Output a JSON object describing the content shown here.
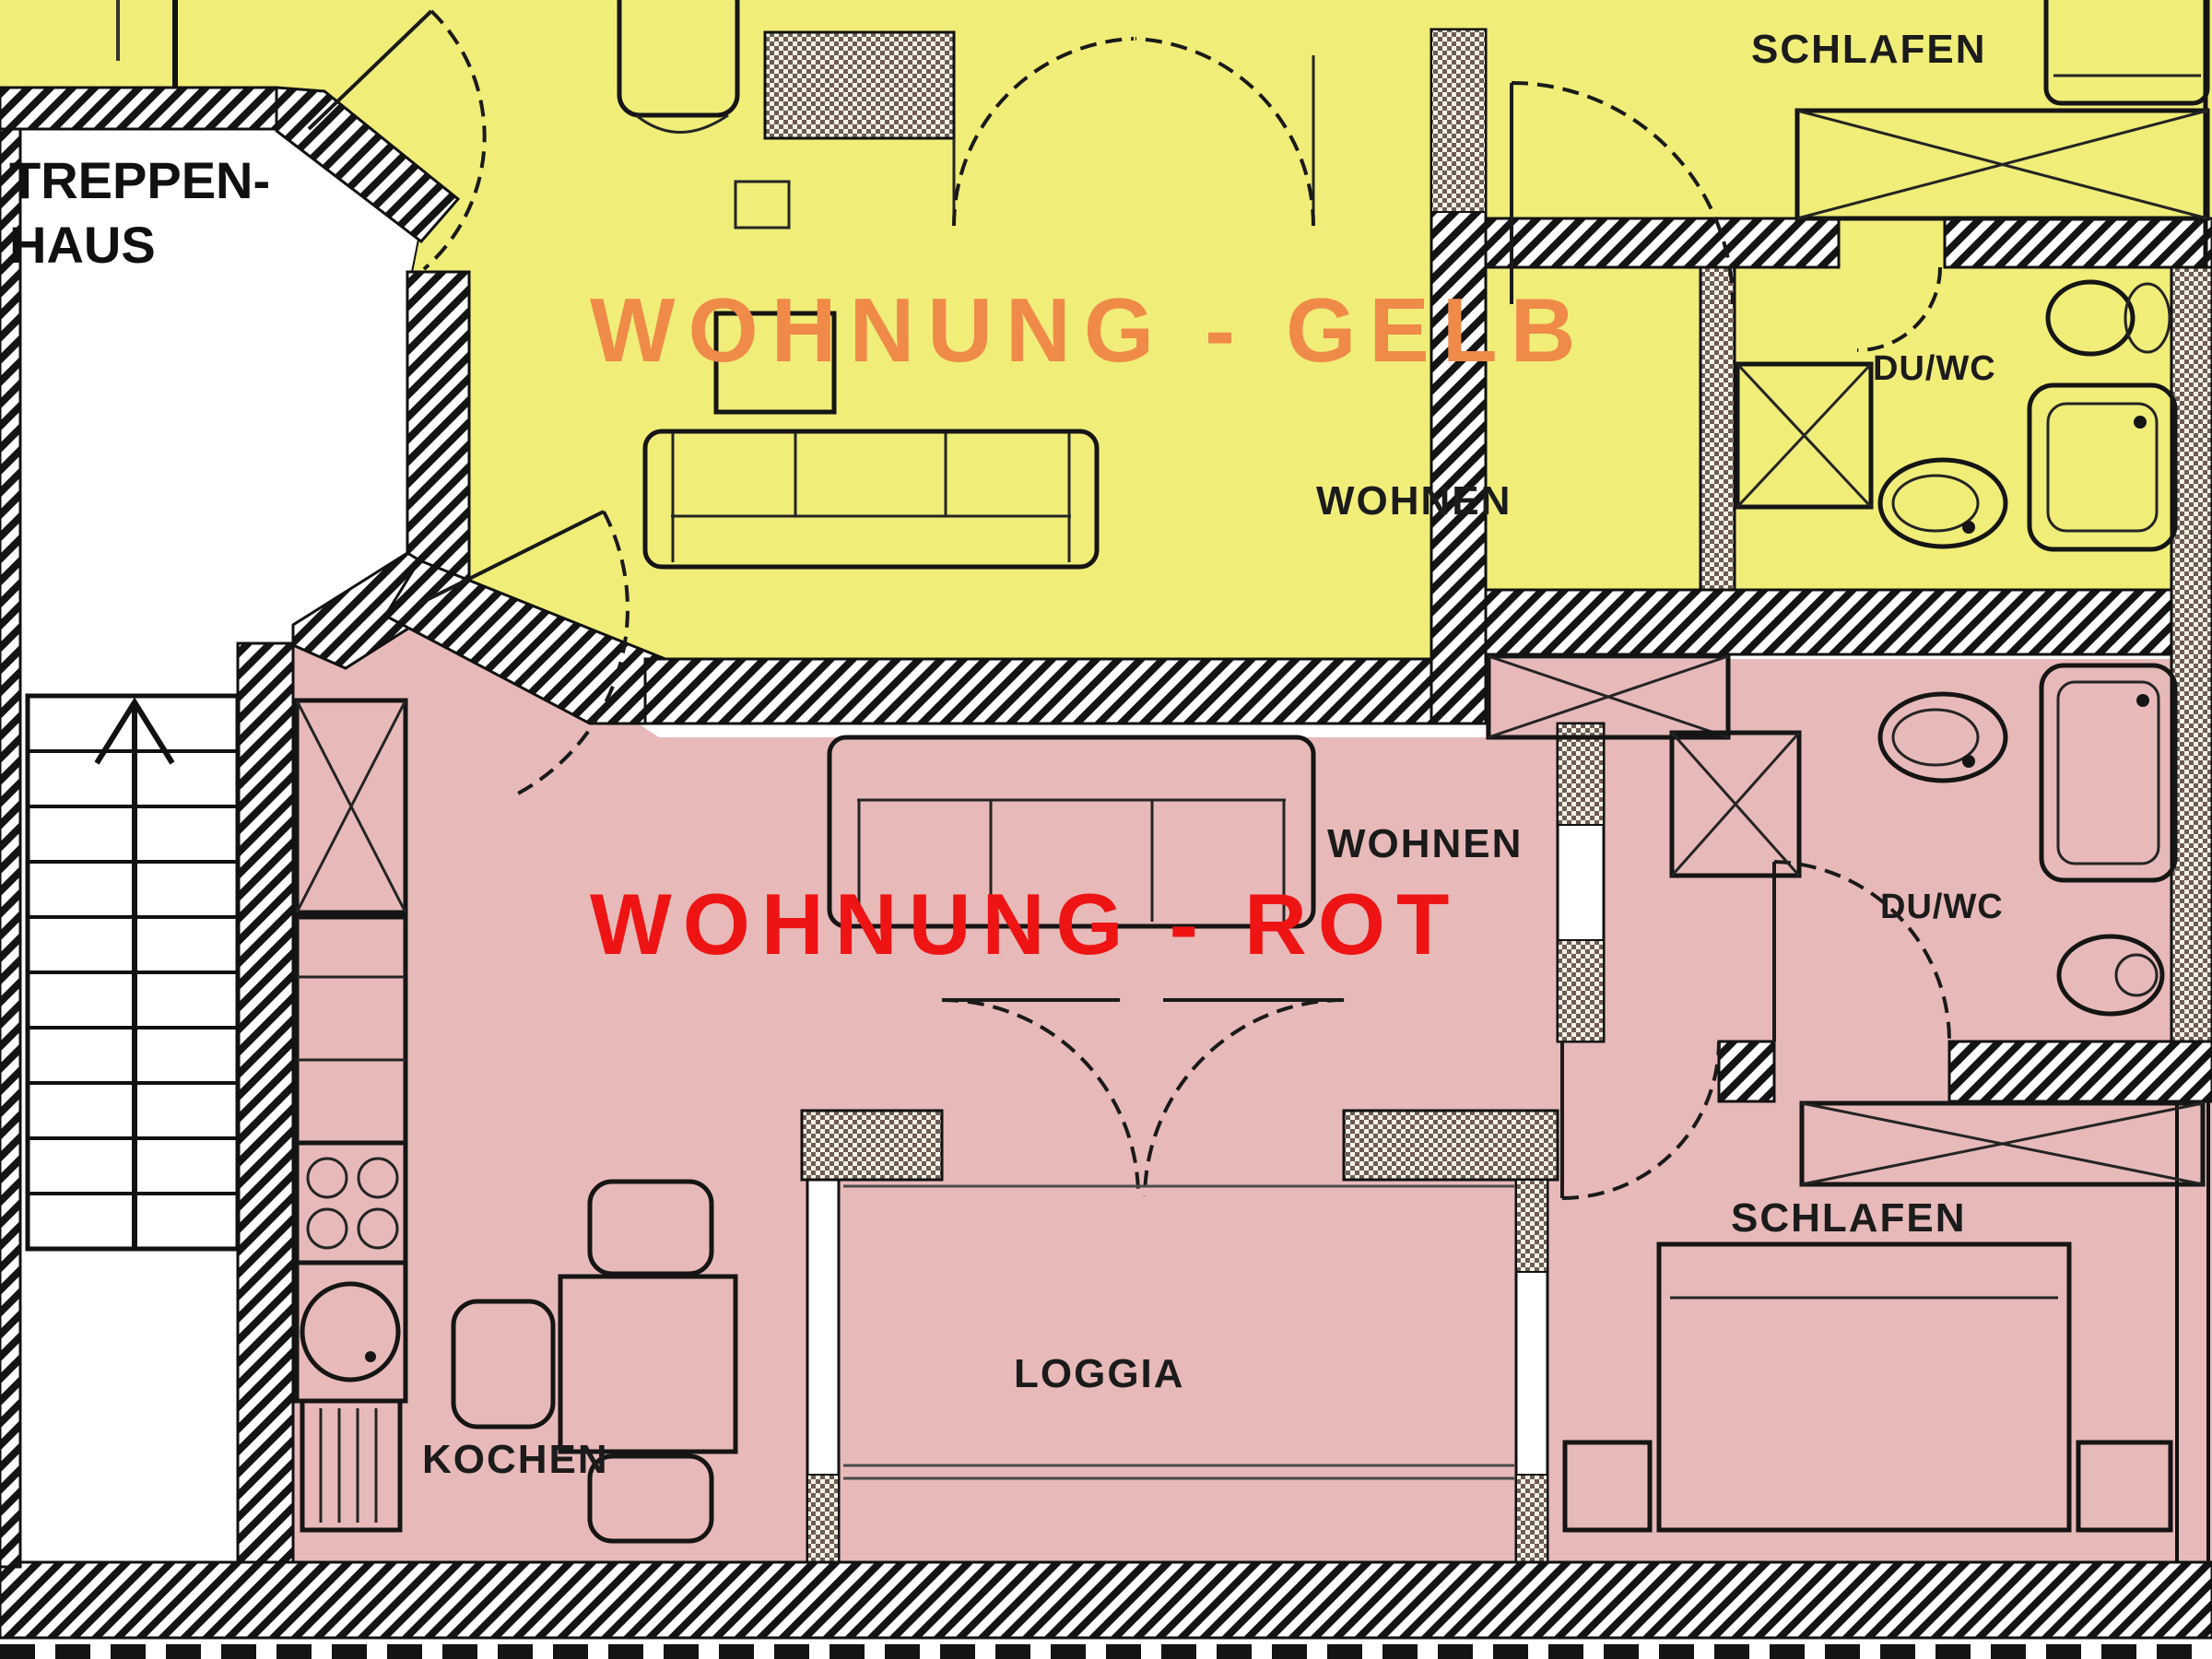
{
  "title": "Grundriss – Wohnung Gelb / Wohnung Rot",
  "colors": {
    "gelb_floor": "#f0ed79",
    "rot_floor": "#e8b9b9",
    "gelb_title": "#ef8a49",
    "rot_title": "#ee1414",
    "label": "#1b1b1b"
  },
  "staircase": {
    "label_line1": "TREPPEN-",
    "label_line2": "HAUS"
  },
  "apartment_gelb": {
    "name": "WOHNUNG - GELB",
    "rooms": {
      "wohnen": "WOHNEN",
      "schlafen": "SCHLAFEN",
      "duwc": "DU/WC"
    }
  },
  "apartment_rot": {
    "name": "WOHNUNG - ROT",
    "rooms": {
      "wohnen": "WOHNEN",
      "schlafen": "SCHLAFEN",
      "duwc": "DU/WC",
      "loggia": "LOGGIA",
      "kochen": "KOCHEN"
    }
  }
}
